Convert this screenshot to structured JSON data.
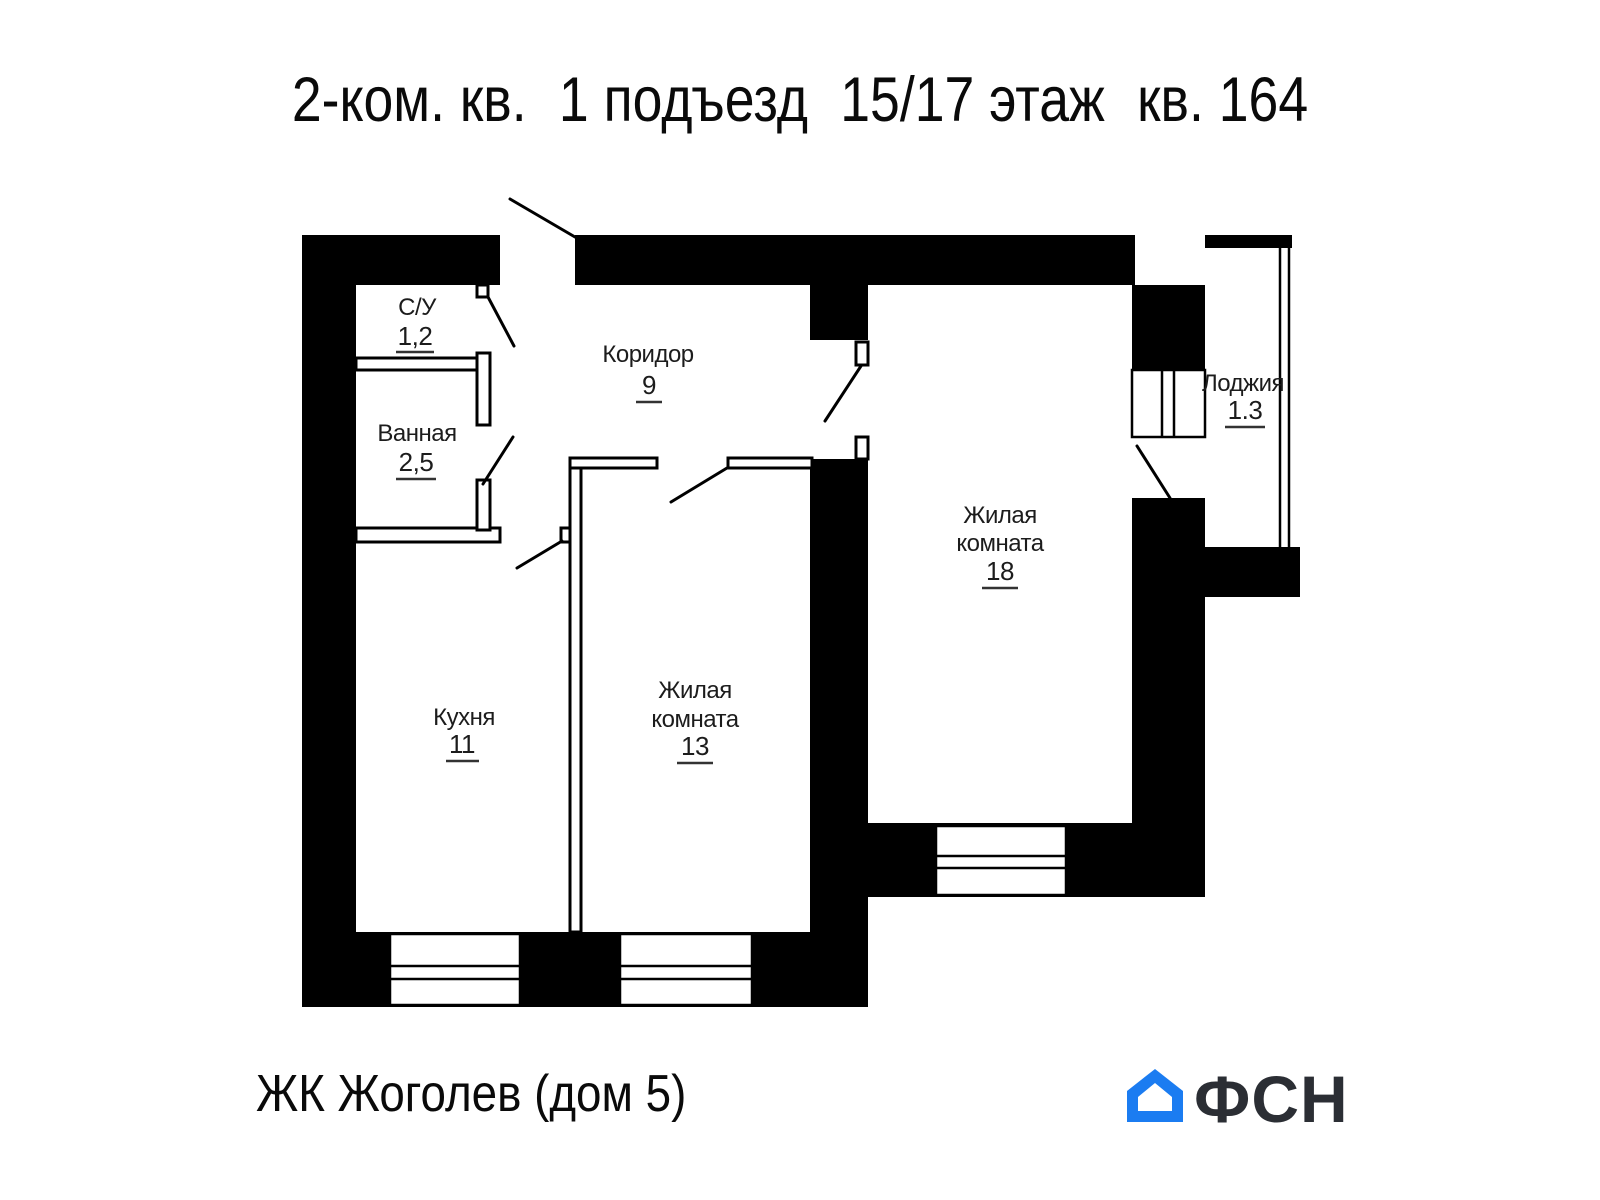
{
  "title": {
    "part1": "2-ком. кв.",
    "part2": "1 подъезд",
    "part3": "15/17 этаж",
    "part4": "кв. 164"
  },
  "plan": {
    "wall_color": "#000000",
    "rooms": {
      "su": {
        "name": "С/У",
        "area": "1,2"
      },
      "bath": {
        "name": "Ванная",
        "area": "2,5"
      },
      "corridor": {
        "name": "Коридор",
        "area": "9"
      },
      "kitchen": {
        "name": "Кухня",
        "area": "11"
      },
      "room13": {
        "line1": "Жилая",
        "line2": "комната",
        "area": "13"
      },
      "room18": {
        "line1": "Жилая",
        "line2": "комната",
        "area": "18"
      },
      "loggia": {
        "name": "Лоджия",
        "area": "1.3"
      }
    }
  },
  "footer": {
    "project": "ЖК Жоголев (дом 5)"
  },
  "logo": {
    "text": "ФСН",
    "house_color": "#1b7cf1",
    "text_color": "#2b2e34"
  }
}
